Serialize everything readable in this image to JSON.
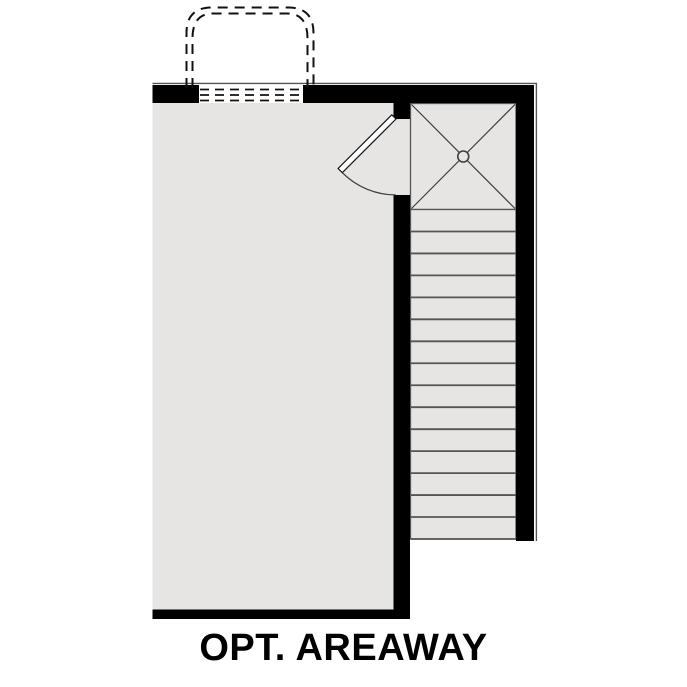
{
  "label": {
    "text": "OPT. AREAWAY"
  },
  "colors": {
    "background": "#ffffff",
    "wall": "#000000",
    "floor": "#e6e5e3",
    "tread-line": "#555555",
    "detail-line": "#3f3f3f",
    "dash-line": "#111111",
    "text": "#000000"
  },
  "stairs": {
    "tread_count": 15,
    "x_left": 411,
    "x_right": 516,
    "y_top": 209.5,
    "y_bottom": 539
  }
}
